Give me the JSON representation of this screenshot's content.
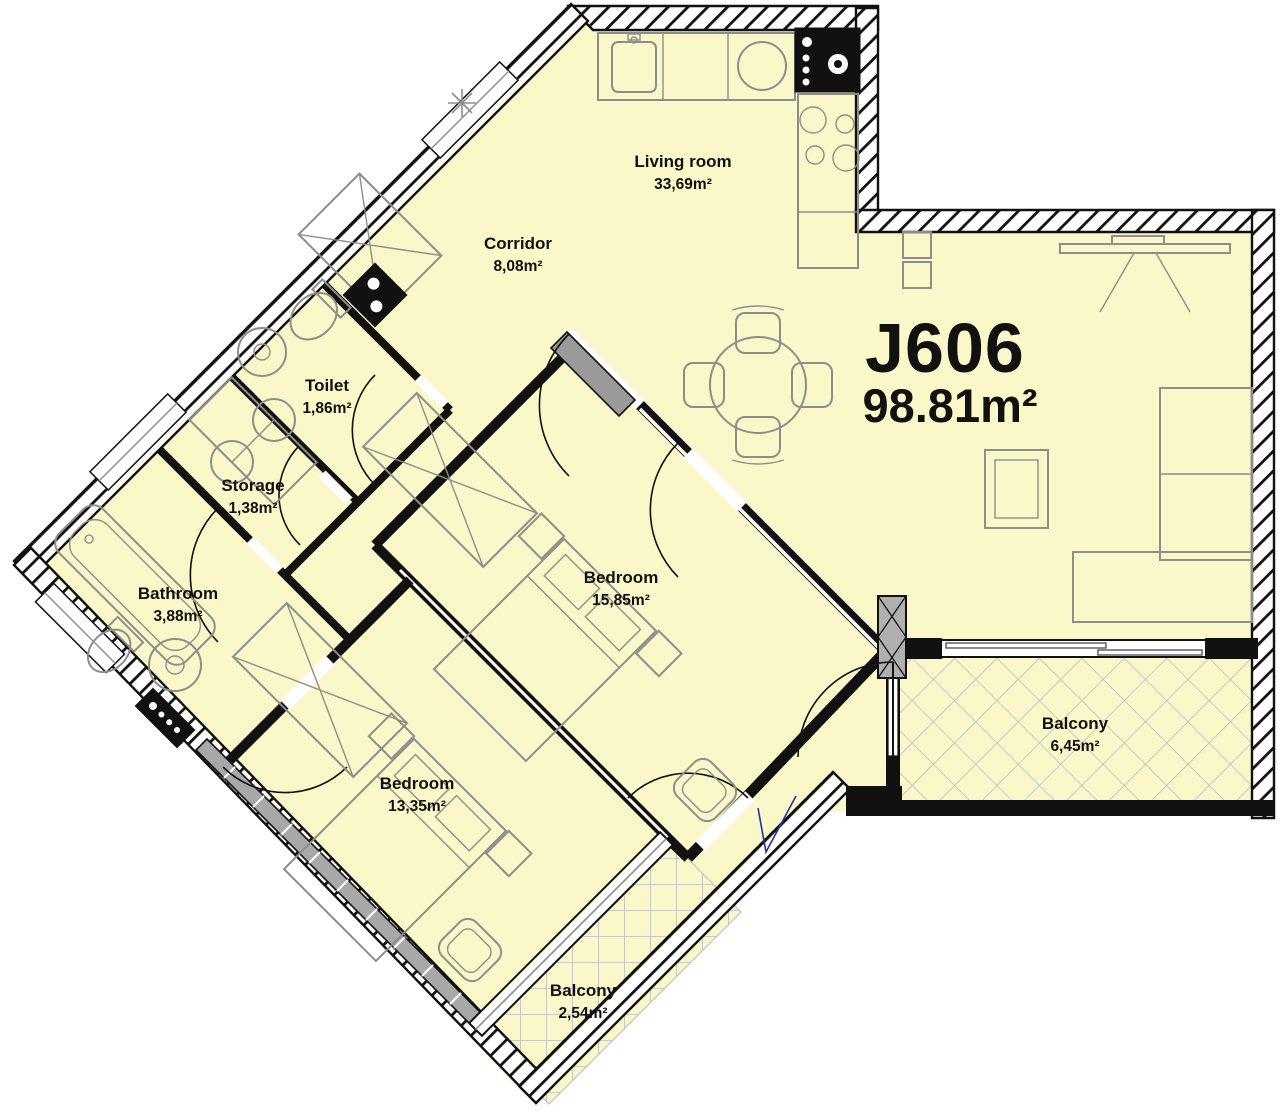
{
  "plan": {
    "unit": "J606",
    "total_area": "98.81m²",
    "rooms": [
      {
        "name": "Living room",
        "area": "33,69m²"
      },
      {
        "name": "Corridor",
        "area": "8,08m²"
      },
      {
        "name": "Toilet",
        "area": "1,86m²"
      },
      {
        "name": "Storage",
        "area": "1,38m²"
      },
      {
        "name": "Bathroom",
        "area": "3,88m²"
      },
      {
        "name": "Bedroom",
        "area": "15,85m²"
      },
      {
        "name": "Bedroom",
        "area": "13,35m²"
      },
      {
        "name": "Balcony",
        "area": "6,45m²"
      },
      {
        "name": "Balcony",
        "area": "2,54m²"
      }
    ],
    "colors": {
      "floor": "#faf8c8",
      "wall": "#111111",
      "furniture": "#8d8d8d",
      "balcony_grid": "#b8bcc4",
      "annotation": "#2233aa"
    }
  }
}
